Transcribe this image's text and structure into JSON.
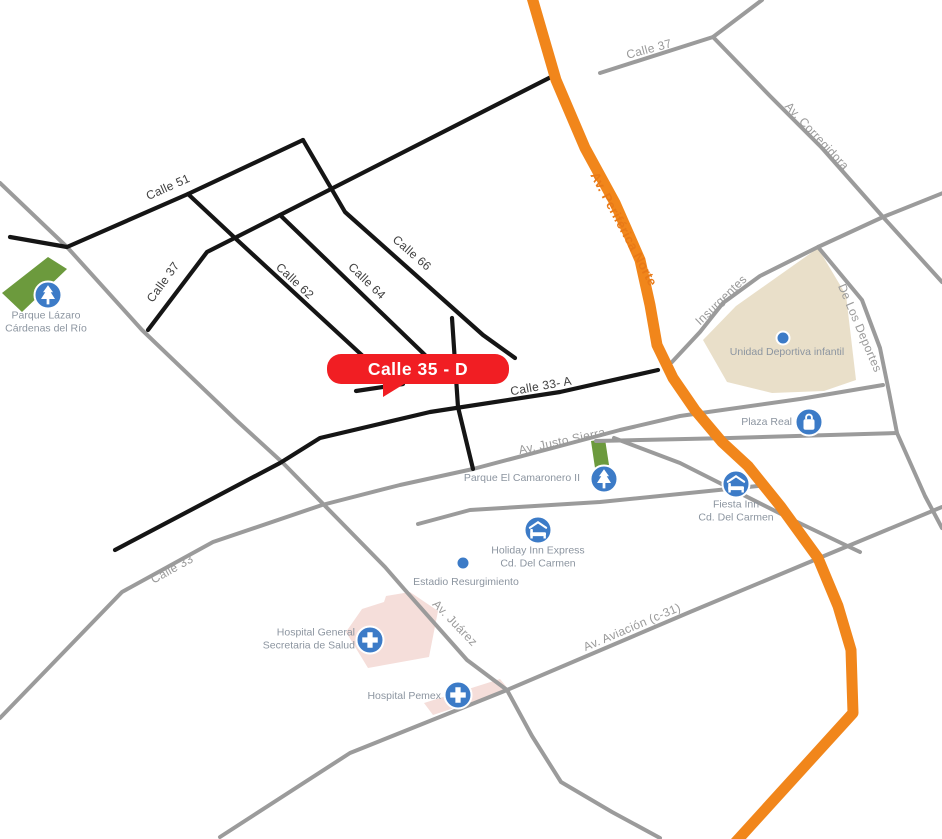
{
  "map": {
    "callout": {
      "label": "Calle 35 - D"
    },
    "streets": {
      "calle_51": "Calle 51",
      "calle_37_black": "Calle 37",
      "calle_62": "Calle 62",
      "calle_64": "Calle 64",
      "calle_66": "Calle 66",
      "calle_33a": "Calle 33- A",
      "calle_33": "Calle 33",
      "calle_37_gray": "Calle 37",
      "av_corregidora": "Av. Corregidora",
      "insurgentes": "Insurgentes",
      "de_los_deportes": "De Los Deportes",
      "av_justo_sierra": "Av. Justo Sierra",
      "av_periferica_norte": "Av. Periférica Norte",
      "av_juarez": "Av. Juárez",
      "av_aviacion": "Av. Aviación (c-31)"
    },
    "pois": {
      "parque_lazaro": {
        "line1": "Parque Lázaro",
        "line2": "Cárdenas del Río",
        "icon": "tree-icon"
      },
      "unidad_deportiva": {
        "label": "Unidad Deportiva infantil",
        "icon": "dot-marker"
      },
      "plaza_real": {
        "label": "Plaza Real",
        "icon": "shopping-bag-icon"
      },
      "parque_camaronero": {
        "label": "Parque El Camaronero II",
        "icon": "tree-icon"
      },
      "fiesta_inn": {
        "line1": "Fiesta Inn",
        "line2": "Cd. Del Carmen",
        "icon": "lodging-icon"
      },
      "holiday_inn": {
        "line1": "Holiday Inn Express",
        "line2": "Cd. Del Carmen",
        "icon": "lodging-icon"
      },
      "estadio": {
        "label": "Estadio Resurgimiento",
        "icon": "dot-marker"
      },
      "hospital_general": {
        "line1": "Hospital General",
        "line2": "Secretaria de Salud",
        "icon": "hospital-cross-icon"
      },
      "hospital_pemex": {
        "label": "Hospital Pemex",
        "icon": "hospital-cross-icon"
      }
    },
    "colors": {
      "background": "#FFFFFF",
      "highway_orange": "#F1861B",
      "highway_label_orange": "#E87917",
      "highlight_red": "#F11E23",
      "road_black": "#151515",
      "road_gray": "#9B9B9B",
      "street_label_dark": "#3F3F3F",
      "street_label_gray": "#9A9A9A",
      "poi_label": "#8C95A0",
      "poi_icon_blue": "#3C7BC7",
      "park_green": "#6C9A3D",
      "area_tan": "#E9DFC9",
      "area_pink": "#F5DEDA"
    }
  }
}
